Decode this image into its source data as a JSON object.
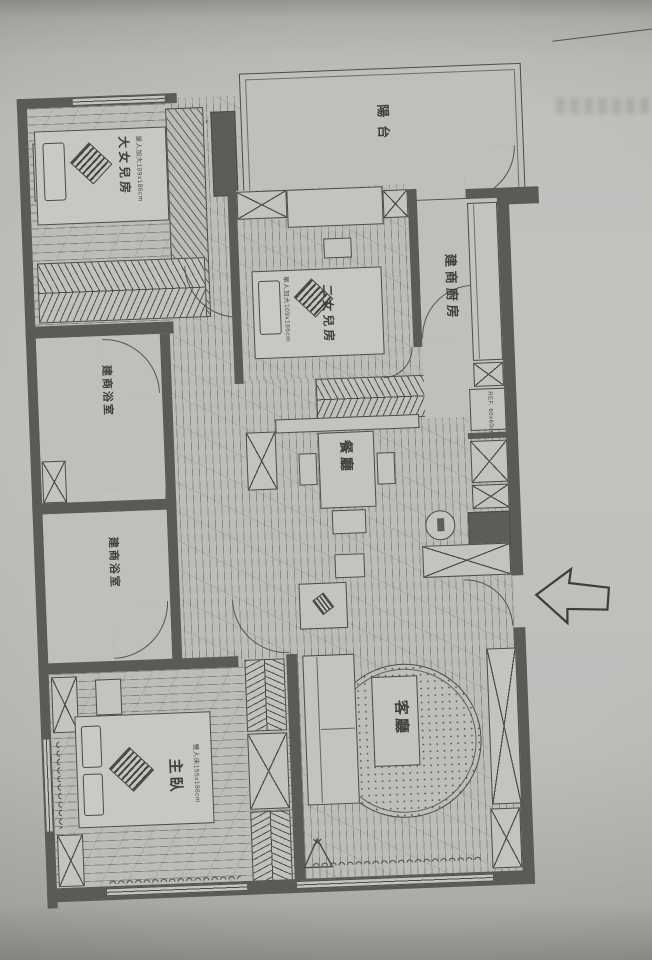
{
  "plan": {
    "balcony": {
      "label": "陽台"
    },
    "elder_daughter_room": {
      "label": "大女兒房",
      "bed_label": "單人加大109x186cm"
    },
    "second_daughter_room": {
      "label": "二女兒房",
      "bed_label": "單人加大109x186cm"
    },
    "kitchen": {
      "label": "建商廚房",
      "fridge_label": "REF. 60x60cm"
    },
    "bath_upper": {
      "label": "建商浴室"
    },
    "bath_lower": {
      "label": "建商浴室"
    },
    "dining": {
      "label": "餐廳"
    },
    "living": {
      "label": "客廳"
    },
    "master_bedroom": {
      "label": "主臥",
      "bed_label": "雙人床155x186cm"
    }
  },
  "colors": {
    "paper": "#bcbbb8",
    "wall": "#5b5a54",
    "line": "#4c4b47",
    "furniture": "#c4c3bf",
    "dark_box": "#5d5c56"
  }
}
